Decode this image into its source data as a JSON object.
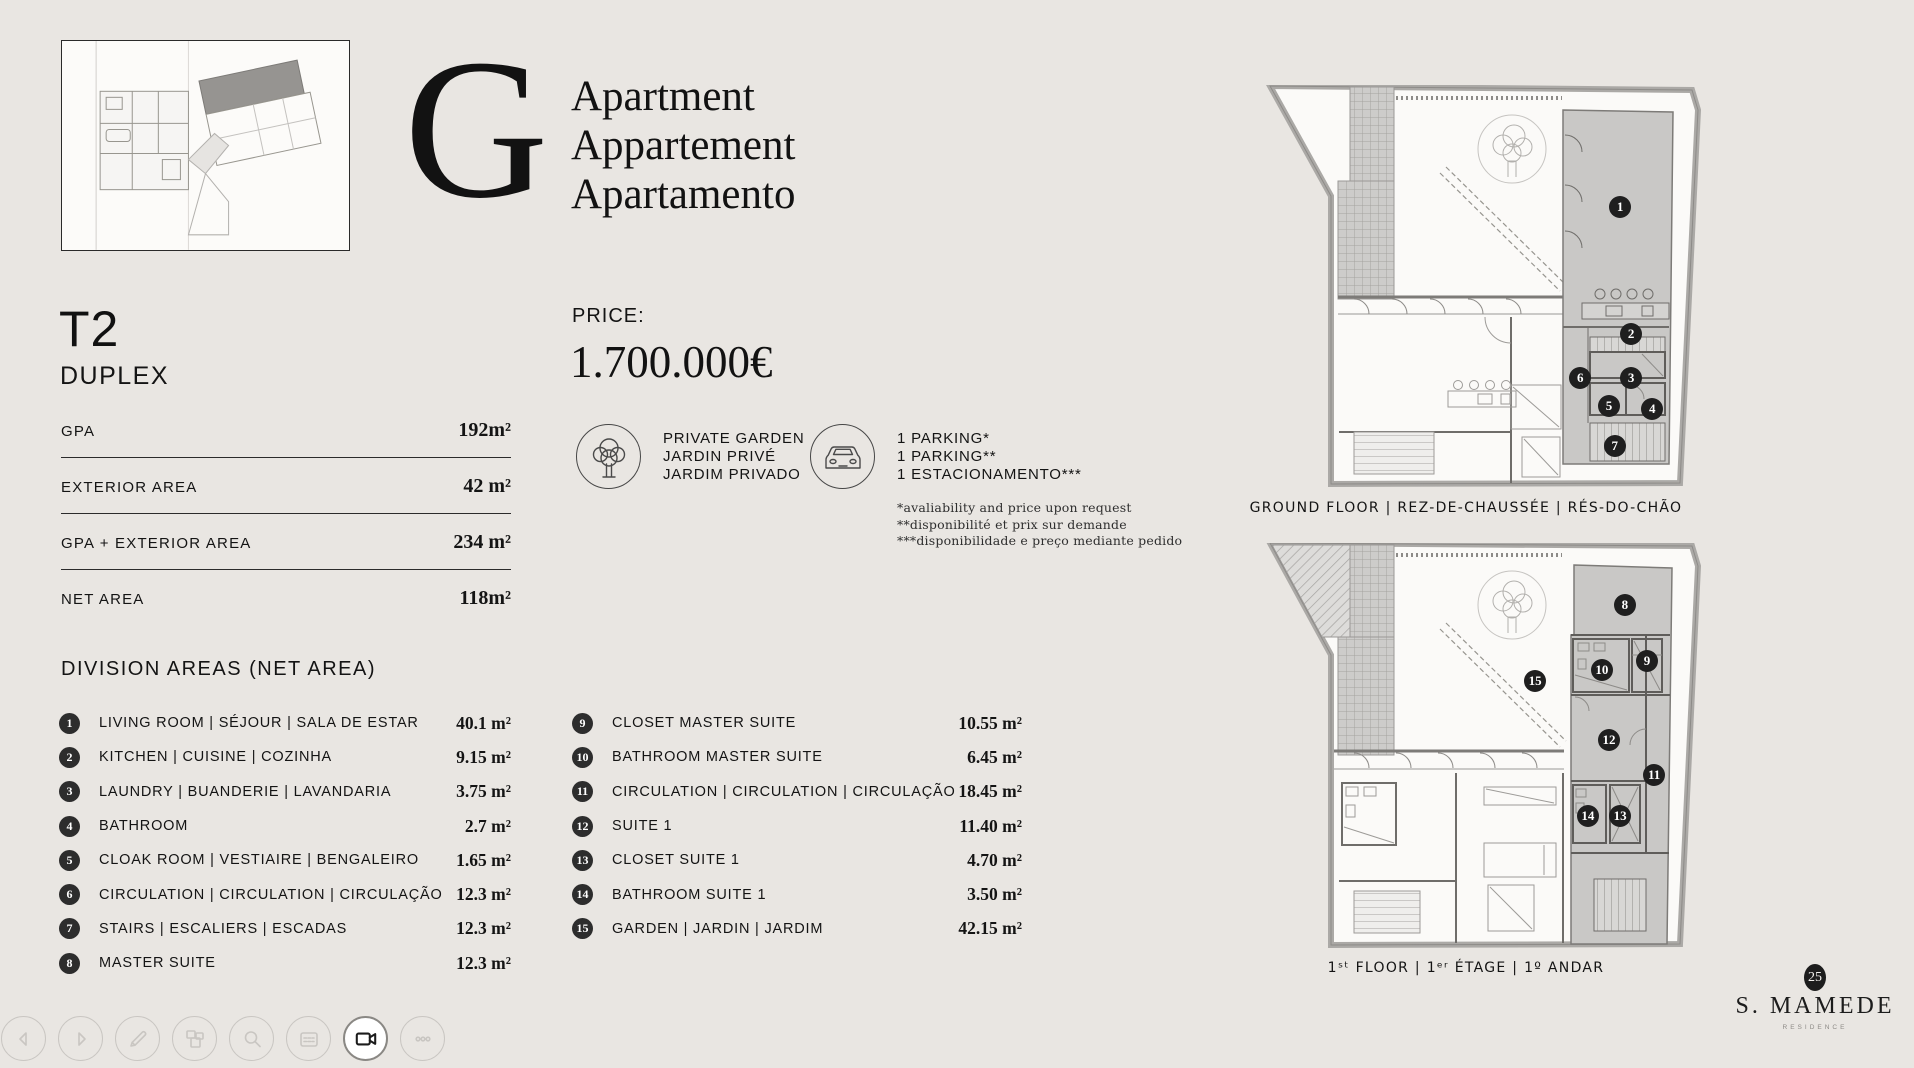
{
  "title": {
    "letter": "G",
    "lines": [
      "Apartment",
      "Appartement",
      "Apartamento"
    ]
  },
  "unit": {
    "type": "T2",
    "layout": "DUPLEX"
  },
  "summary_areas": [
    {
      "label": "GPA",
      "value": "192m²"
    },
    {
      "label": "EXTERIOR AREA",
      "value": "42 m²"
    },
    {
      "label": "GPA + EXTERIOR AREA",
      "value": "234 m²"
    },
    {
      "label": "NET AREA",
      "value": "118m²"
    }
  ],
  "division": {
    "heading": "DIVISION AREAS (NET AREA)",
    "left": [
      {
        "n": "1",
        "label": "LIVING ROOM | SÉJOUR | SALA DE ESTAR",
        "value": "40.1 m²"
      },
      {
        "n": "2",
        "label": "KITCHEN | CUISINE | COZINHA",
        "value": "9.15 m²"
      },
      {
        "n": "3",
        "label": "LAUNDRY | BUANDERIE | LAVANDARIA",
        "value": "3.75 m²"
      },
      {
        "n": "4",
        "label": "BATHROOM",
        "value": "2.7 m²"
      },
      {
        "n": "5",
        "label": "CLOAK ROOM | VESTIAIRE | BENGALEIRO",
        "value": "1.65 m²"
      },
      {
        "n": "6",
        "label": "CIRCULATION | CIRCULATION | CIRCULAÇÃO",
        "value": "12.3 m²"
      },
      {
        "n": "7",
        "label": "STAIRS | ESCALIERS | ESCADAS",
        "value": "12.3 m²"
      },
      {
        "n": "8",
        "label": "MASTER SUITE",
        "value": "12.3 m²"
      }
    ],
    "right": [
      {
        "n": "9",
        "label": "CLOSET MASTER SUITE",
        "value": "10.55 m²"
      },
      {
        "n": "10",
        "label": "BATHROOM MASTER SUITE",
        "value": "6.45 m²"
      },
      {
        "n": "11",
        "label": "CIRCULATION | CIRCULATION | CIRCULAÇÃO",
        "value": "18.45 m²"
      },
      {
        "n": "12",
        "label": "SUITE 1",
        "value": "11.40 m²"
      },
      {
        "n": "13",
        "label": "CLOSET SUITE 1",
        "value": "4.70 m²"
      },
      {
        "n": "14",
        "label": "BATHROOM SUITE 1",
        "value": "3.50 m²"
      },
      {
        "n": "15",
        "label": "GARDEN | JARDIN | JARDIM",
        "value": "42.15 m²"
      }
    ]
  },
  "price": {
    "label": "PRICE:",
    "value": "1.700.000€"
  },
  "features": {
    "garden": {
      "icon": "tree-icon",
      "lines": [
        "PRIVATE GARDEN",
        "JARDIN PRIVÉ",
        "JARDIM PRIVADO"
      ]
    },
    "parking": {
      "icon": "car-icon",
      "lines": [
        "1 PARKING*",
        "1 PARKING**",
        "1 ESTACIONAMENTO***"
      ],
      "notes": [
        "*avaliability and price upon request",
        "**disponibilité et prix sur demande",
        "***disponibilidade e preço mediante pedido"
      ]
    }
  },
  "plans": [
    {
      "caption": "GROUND FLOOR | REZ-DE-CHAUSSÉE | RÉS-DO-CHÃO",
      "badges": [
        {
          "n": "1",
          "x": 82.1,
          "y": 29.6
        },
        {
          "n": "2",
          "x": 84.4,
          "y": 60.4
        },
        {
          "n": "3",
          "x": 84.4,
          "y": 71.1
        },
        {
          "n": "4",
          "x": 88.8,
          "y": 78.6
        },
        {
          "n": "5",
          "x": 79.8,
          "y": 77.9
        },
        {
          "n": "6",
          "x": 73.8,
          "y": 71.1
        },
        {
          "n": "7",
          "x": 81.0,
          "y": 87.6
        }
      ]
    },
    {
      "caption": "1ˢᵗ FLOOR | 1ᵉʳ ÉTAGE | 1º ANDAR",
      "badges": [
        {
          "n": "8",
          "x": 83.1,
          "y": 14.9
        },
        {
          "n": "9",
          "x": 87.7,
          "y": 28.5
        },
        {
          "n": "10",
          "x": 78.3,
          "y": 30.7
        },
        {
          "n": "11",
          "x": 89.2,
          "y": 56.1
        },
        {
          "n": "12",
          "x": 79.8,
          "y": 47.7
        },
        {
          "n": "13",
          "x": 82.1,
          "y": 66.0
        },
        {
          "n": "14",
          "x": 75.4,
          "y": 66.0
        },
        {
          "n": "15",
          "x": 64.4,
          "y": 33.3
        }
      ]
    }
  ],
  "toolbar": {
    "buttons": [
      {
        "name": "previous"
      },
      {
        "name": "next"
      },
      {
        "name": "annotate"
      },
      {
        "name": "pages"
      },
      {
        "name": "search"
      },
      {
        "name": "notes"
      },
      {
        "name": "camera",
        "active": true
      },
      {
        "name": "more"
      }
    ]
  },
  "logo": {
    "badge": "25",
    "name": "S. MAMEDE",
    "sub": "RESIDENCE"
  }
}
